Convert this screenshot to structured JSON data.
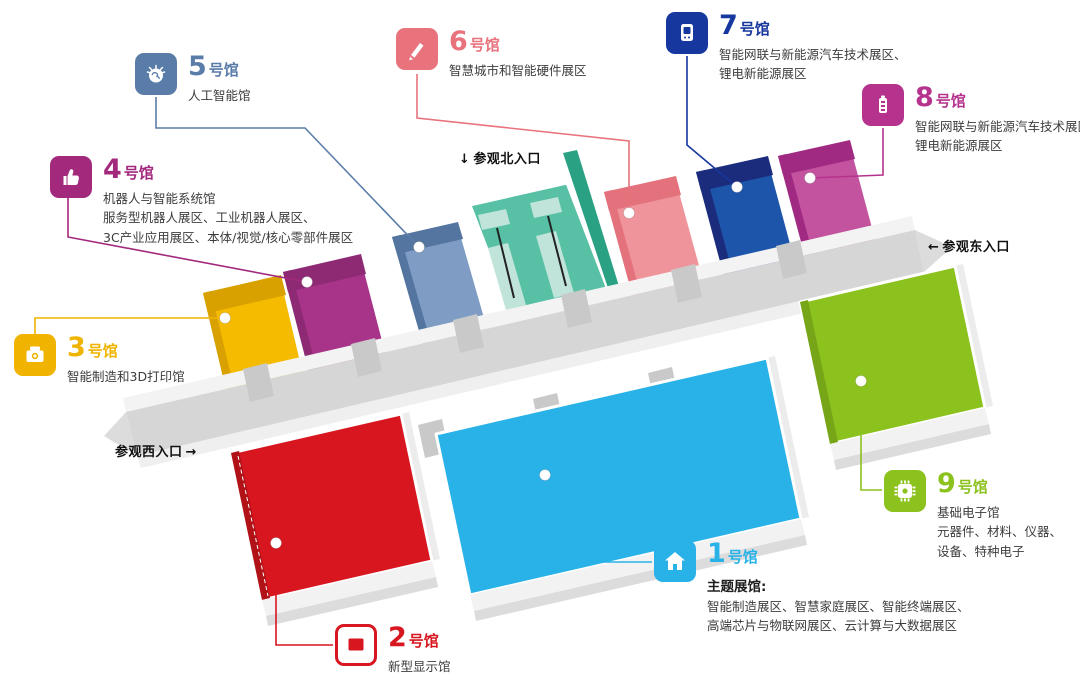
{
  "map_colors": {
    "corridor": "#d6d6d6",
    "corridor_wall": "#f3f3f3",
    "entrance_floor": "#57c0a5",
    "entrance_wall": "#2aa183",
    "entrance_ramp": "#c0e4d9",
    "anchor_dot": "#ffffff"
  },
  "entrances": [
    {
      "id": "north",
      "label": "参观北入口",
      "arrow": "↓",
      "arrow_position": "before"
    },
    {
      "id": "east",
      "label": "参观东入口",
      "arrow": "←",
      "arrow_position": "before"
    },
    {
      "id": "west",
      "label": "参观西入口",
      "arrow": "→",
      "arrow_position": "after"
    }
  ],
  "halls": [
    {
      "num": "1",
      "suffix": "号馆",
      "icon": "home-icon",
      "color": "#29b2e8",
      "floor": "#29b2e8",
      "wall": "#1e98cc",
      "lead": "主题展馆:",
      "lines": [
        "智能制造展区、智慧家庭展区、智能终端展区、",
        "高端芯片与物联网展区、云计算与大数据展区"
      ]
    },
    {
      "num": "2",
      "suffix": "号馆",
      "icon": "display-icon",
      "color": "#d7161f",
      "floor": "#d7161f",
      "wall": "#b01218",
      "lines": [
        "新型显示馆"
      ]
    },
    {
      "num": "3",
      "suffix": "号馆",
      "icon": "printer-3d-icon",
      "color": "#f0b400",
      "floor": "#f5bb00",
      "wall": "#d9a100",
      "lines": [
        "智能制造和3D打印馆"
      ]
    },
    {
      "num": "4",
      "suffix": "号馆",
      "icon": "hand-icon",
      "color": "#a3297d",
      "floor": "#a8348a",
      "wall": "#8e2a74",
      "lines": [
        "机器人与智能系统馆",
        "服务型机器人展区、工业机器人展区、",
        "3C产业应用展区、本体/视觉/核心零部件展区"
      ]
    },
    {
      "num": "5",
      "suffix": "号馆",
      "icon": "brain-icon",
      "color": "#5a7ca8",
      "floor": "#7e9cc4",
      "wall": "#54759f",
      "lines": [
        "人工智能馆"
      ]
    },
    {
      "num": "6",
      "suffix": "号馆",
      "icon": "pen-icon",
      "color": "#e8737d",
      "floor": "#f0949b",
      "wall": "#e4727c",
      "lines": [
        "智慧城市和智能硬件展区"
      ]
    },
    {
      "num": "7",
      "suffix": "号馆",
      "icon": "ev-charger-icon",
      "color": "#16379e",
      "floor": "#1d55ab",
      "wall": "#1b2c7d",
      "lines": [
        "智能网联与新能源汽车技术展区、",
        "锂电新能源展区"
      ]
    },
    {
      "num": "8",
      "suffix": "号馆",
      "icon": "battery-icon",
      "color": "#b5338c",
      "floor": "#c4539f",
      "wall": "#a02a82",
      "lines": [
        "智能网联与新能源汽车技术展区",
        "锂电新能源展区"
      ]
    },
    {
      "num": "9",
      "suffix": "号馆",
      "icon": "chip-icon",
      "color": "#8cc21d",
      "floor": "#8cc21d",
      "wall": "#76a518",
      "lines": [
        "基础电子馆",
        "元器件、材料、仪器、",
        "设备、特种电子"
      ]
    }
  ]
}
